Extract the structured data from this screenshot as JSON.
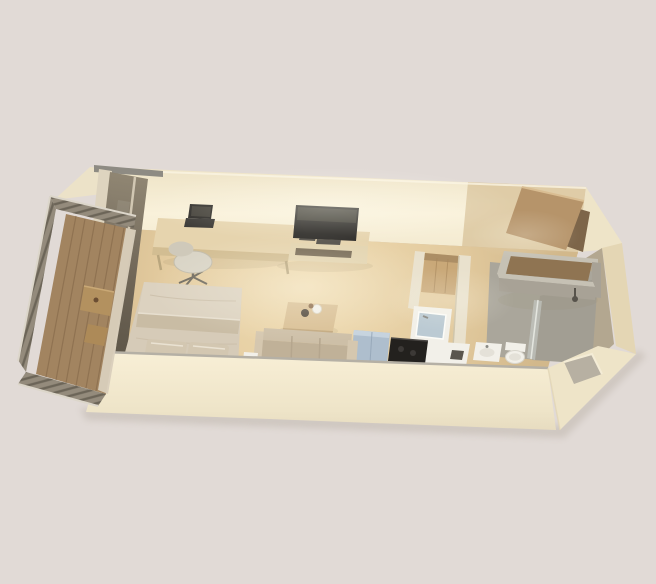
{
  "scene": {
    "type": "3d-cutaway-floor-plan",
    "subject": "studio apartment axonometric render with balcony, bedroom-living area, kitchenette, bathroom and entry",
    "rooms": [
      "balcony",
      "bedroom-living-area",
      "kitchenette",
      "bathroom",
      "entry"
    ],
    "furniture": [
      "balcony-table",
      "balcony-stool",
      "desk",
      "laptop",
      "office-chair",
      "double-bed",
      "pillows",
      "tv",
      "tv-console",
      "coffee-table",
      "sofa",
      "refrigerator",
      "cooktop",
      "kitchen-sink",
      "kitchen-cabinet",
      "vanity-sink",
      "toilet",
      "shower",
      "glass-partition",
      "entry-door"
    ]
  },
  "palette": {
    "background": "#e1dad6",
    "ground_shadow": "#b9b0a6",
    "wall_top_gray": "#8e8b83",
    "wall_light": "#f9f1da",
    "wall_mid": "#eee3c6",
    "wall_mid2": "#f3ead0",
    "wall_tan": "#d9c49c",
    "wall_wedge": "#ece2c8",
    "wall_shadow": "#e4d6b4",
    "band_light": "#f8efd6",
    "band_mid": "#eee4c8",
    "band_bottom": "#e7dcc0",
    "band_gray_edge": "#b5b0a5",
    "notch_gray": "#b7b0a2",
    "glass_light": "#8d8370",
    "glass_dark": "#6a6153",
    "glass_darker": "#524c40",
    "frame_light": "#ded4bf",
    "floor_light": "#f0dcb2",
    "floor_mid": "#e3cb9f",
    "floor_dark": "#d2b88b",
    "deck_wood": "#a28460",
    "deck_line": "#85694a",
    "rail_base": "#948b7c",
    "rail_slat": "#5f584c",
    "rail_white": "#dcd6ca",
    "threshold": "#d9cfbc",
    "furn_wood": "#e6d4ae",
    "furn_wood_dark": "#d2bd92",
    "console_front": "#e3d4b0",
    "shelf_dark": "#6b5f4c",
    "device_gray": "#55514a",
    "cabinet_wood": "#c9a878",
    "cabinet_line": "#a9885c",
    "cabinet_shade": "#8a6f4e",
    "tv_black": "#2c2a27",
    "tv_sheen": "#434039",
    "laptop_base": "#3b3936",
    "linen": "#d6cbb8",
    "linen_light": "#dcd2c0",
    "linen_fold": "#c9bca4",
    "pillow": "#d3c7b1",
    "sofa": "#cdbfa7",
    "sofa_seat": "#c0b198",
    "sofa_arm": "#d5c7af",
    "sofa_line": "#b5a68e",
    "chair_seat": "#d9d4c6",
    "chair_back": "#cfc9ba",
    "chair_metal": "#6f6a5f",
    "desk_leg": "#b9a67e",
    "table_wood": "#d9bf94",
    "table_edge": "#c2a87e",
    "appliance_blue": "#aebecd",
    "appliance_blue_light": "#c6d3de",
    "cooktop_black": "#23211e",
    "burner": "#3c3936",
    "white_fixture": "#f2f0e9",
    "basin": "#e4e1d8",
    "faucet": "#8a8a85",
    "sink_blue": "#b9c8d2",
    "bath_floor": "#aaa69b",
    "bath_floor_dark": "#a19d92",
    "bath_wall": "#b3a790",
    "box_gray": "#a8a296",
    "box_rim": "#c6c1b4",
    "box_inner": "#8f7452",
    "shower_metal": "#57534b",
    "glass_partition": "#ccd2cd",
    "door_wood": "#b6946a",
    "door_edge": "#d9bd92",
    "door_dark": "#7d6549",
    "stub_wall": "#e9e1cd",
    "item_dark": "#4f463a",
    "item_brown": "#8b6a4a",
    "slot_dark": "#5a564e",
    "balcony_table": "#b3915f",
    "balcony_stool": "#ad8a58",
    "knob": "#6b4e33",
    "ao": "#8a7a5e"
  }
}
